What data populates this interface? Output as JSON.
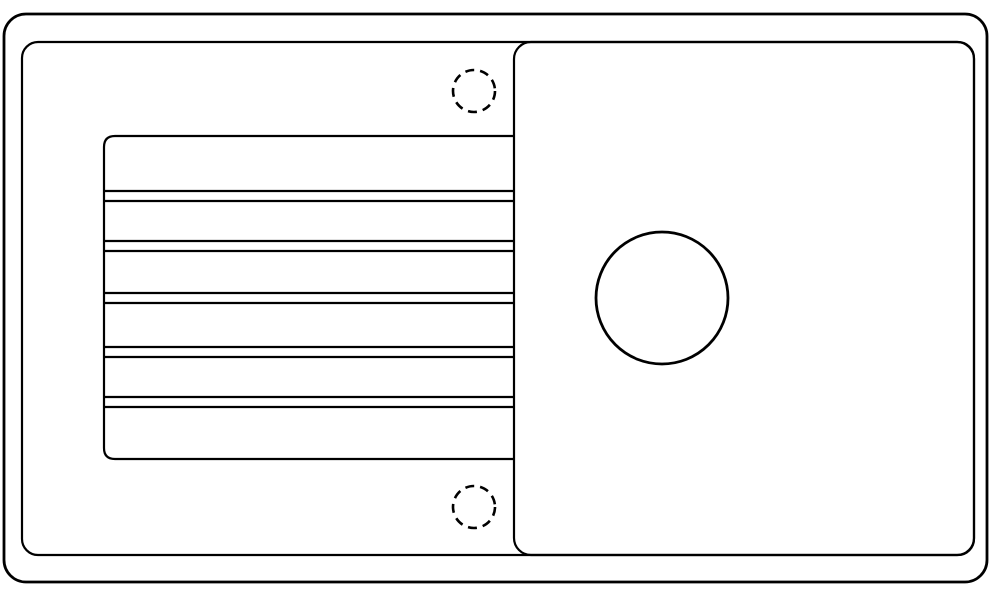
{
  "canvas": {
    "width": 1000,
    "height": 597,
    "background": "#ffffff",
    "stroke_color": "#000000"
  },
  "shapes": [
    {
      "name": "sink-outer-rim-outline",
      "type": "rect",
      "x": 4,
      "y": 14,
      "w": 983,
      "h": 568,
      "rx": 22,
      "stroke_width": 2.8
    },
    {
      "name": "sink-inner-rim-outline",
      "type": "rect",
      "x": 22,
      "y": 42,
      "w": 952,
      "h": 513,
      "rx": 16,
      "stroke_width": 2.2
    },
    {
      "name": "basin-outline",
      "type": "rect",
      "x": 514,
      "y": 42,
      "w": 460,
      "h": 513,
      "rx": 17,
      "stroke_width": 2.2
    },
    {
      "name": "drainboard-outline",
      "type": "path",
      "d": "M 514 136 H 115 Q 104 136 104 147 V 448 Q 104 459 115 459 H 514",
      "stroke_width": 2.2
    },
    {
      "name": "drainboard-ridge-line-1",
      "type": "line",
      "x1": 104,
      "y1": 191,
      "x2": 514,
      "y2": 191,
      "stroke_width": 2.2
    },
    {
      "name": "drainboard-ridge-line-2",
      "type": "line",
      "x1": 104,
      "y1": 201,
      "x2": 514,
      "y2": 201,
      "stroke_width": 2.2
    },
    {
      "name": "drainboard-ridge-line-3",
      "type": "line",
      "x1": 104,
      "y1": 241,
      "x2": 514,
      "y2": 241,
      "stroke_width": 2.2
    },
    {
      "name": "drainboard-ridge-line-4",
      "type": "line",
      "x1": 104,
      "y1": 251,
      "x2": 514,
      "y2": 251,
      "stroke_width": 2.2
    },
    {
      "name": "drainboard-ridge-line-5",
      "type": "line",
      "x1": 104,
      "y1": 293,
      "x2": 514,
      "y2": 293,
      "stroke_width": 2.2
    },
    {
      "name": "drainboard-ridge-line-6",
      "type": "line",
      "x1": 104,
      "y1": 303,
      "x2": 514,
      "y2": 303,
      "stroke_width": 2.2
    },
    {
      "name": "drainboard-ridge-line-7",
      "type": "line",
      "x1": 104,
      "y1": 347,
      "x2": 514,
      "y2": 347,
      "stroke_width": 2.2
    },
    {
      "name": "drainboard-ridge-line-8",
      "type": "line",
      "x1": 104,
      "y1": 357,
      "x2": 514,
      "y2": 357,
      "stroke_width": 2.2
    },
    {
      "name": "drainboard-ridge-line-9",
      "type": "line",
      "x1": 104,
      "y1": 397,
      "x2": 514,
      "y2": 397,
      "stroke_width": 2.2
    },
    {
      "name": "drainboard-ridge-line-10",
      "type": "line",
      "x1": 104,
      "y1": 407,
      "x2": 514,
      "y2": 407,
      "stroke_width": 2.2
    },
    {
      "name": "drain-hole-outline",
      "type": "circle",
      "cx": 662,
      "cy": 298,
      "r": 66,
      "stroke_width": 2.8
    },
    {
      "name": "faucet-hole-top-dashed",
      "type": "circle",
      "cx": 474,
      "cy": 91,
      "r": 21,
      "stroke_width": 2.6,
      "dash": "9 6"
    },
    {
      "name": "faucet-hole-bottom-dashed",
      "type": "circle",
      "cx": 474,
      "cy": 507,
      "r": 21,
      "stroke_width": 2.6,
      "dash": "9 6"
    }
  ]
}
